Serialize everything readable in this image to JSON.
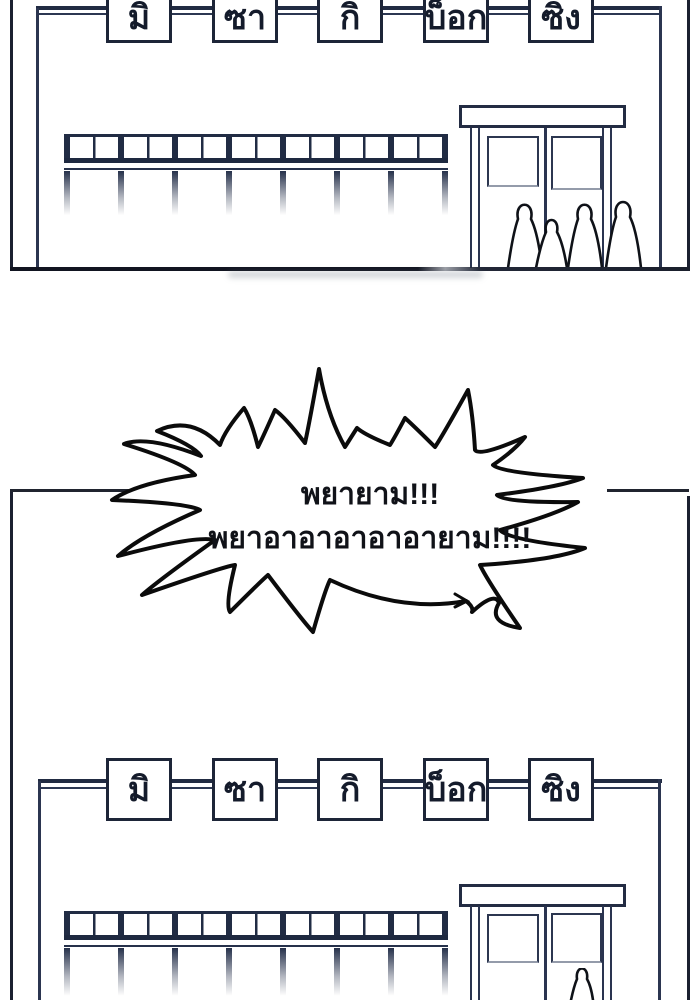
{
  "signs": [
    "มิ",
    "ซา",
    "กิ",
    "บ็อก",
    "ซิง"
  ],
  "bubble": {
    "line1": "พยายาม!!!",
    "line2": "พยาอาอาอาอาอายาม!!!!"
  },
  "colors": {
    "background": "#ffffff",
    "ink_navy": "#212c44",
    "frame_line": "#1b2030",
    "bubble_stroke": "#0b0b0b",
    "text": "#141b2b"
  }
}
